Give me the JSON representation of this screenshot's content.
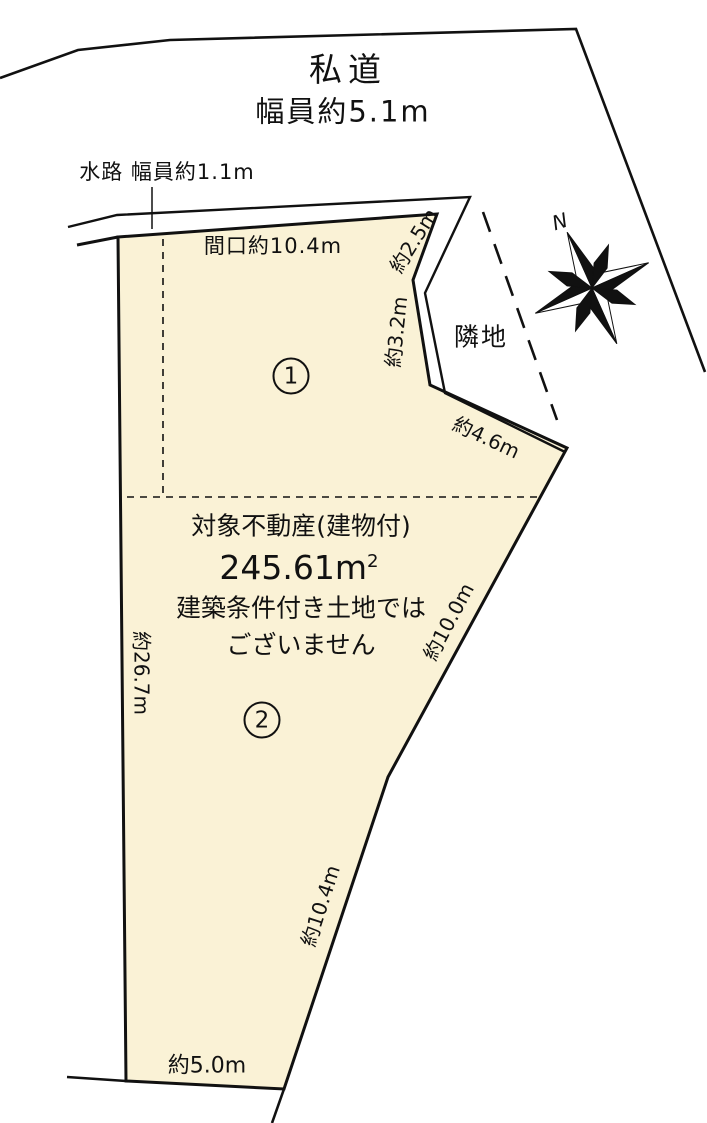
{
  "diagram": {
    "road": {
      "line1": "私道",
      "line2": "幅員約5.1m"
    },
    "waterway_label": "水路 幅員約1.1m",
    "frontage_label": "間口約10.4m",
    "adjacent_label": "隣地",
    "north_label": "N",
    "zone1": "1",
    "zone2": "2",
    "center_text": {
      "title": "対象不動産(建物付)",
      "area_value": "245.61m",
      "area_sup": "2",
      "note1": "建築条件付き土地では",
      "note2": "ございません"
    },
    "measurements": {
      "edge_2_5": "約2.5m",
      "edge_3_2": "約3.2m",
      "edge_4_6": "約4.6m",
      "edge_10_0": "約10.0m",
      "edge_26_7": "約26.7m",
      "edge_10_4": "約10.4m",
      "edge_5_0": "約5.0m"
    },
    "colors": {
      "plot_fill": "#FAF2D6",
      "line": "#111111",
      "background": "#FFFFFF"
    }
  }
}
